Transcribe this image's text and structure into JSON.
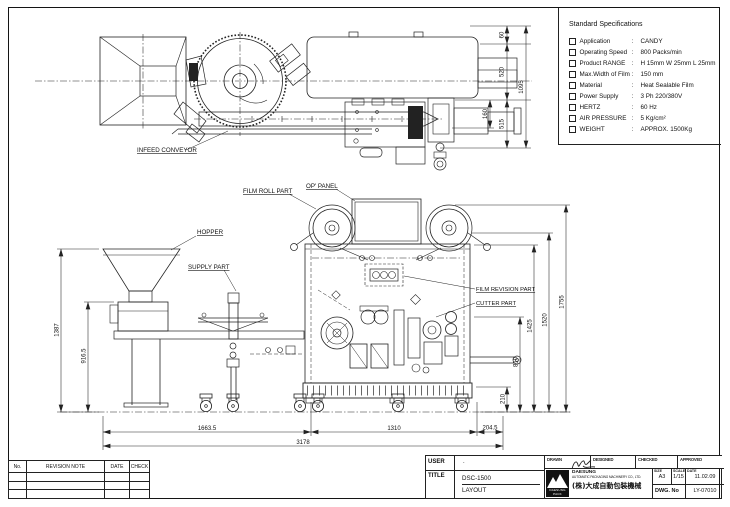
{
  "sheet": {
    "bg": "#ffffff",
    "line_color": "#1f1f1f"
  },
  "spec_panel": {
    "title": "Standard Specifications",
    "sep": ":",
    "items": [
      {
        "label": "Application",
        "value": "CANDY"
      },
      {
        "label": "Operating Speed",
        "value": "800  Packs/min"
      },
      {
        "label": "Product RANGE",
        "value": "H 15mm  W 25mm  L 25mm"
      },
      {
        "label": "Max.Width of Film",
        "value": "150 mm"
      },
      {
        "label": "Material",
        "value": "Heat Sealable Film"
      },
      {
        "label": "Power Supply",
        "value": "3 Ph 220/380V"
      },
      {
        "label": "HERTZ",
        "value": "60 Hz"
      },
      {
        "label": "AIR PRESSURE",
        "value": "5 Kg/cm²"
      },
      {
        "label": "WEIGHT",
        "value": "APPROX. 1500Kg"
      }
    ]
  },
  "part_labels": {
    "infeed_conveyor": "INFEED CONVEYOR",
    "film_roll_part": "FILM ROLL PART",
    "op_panel": "OP' PANEL",
    "hopper": "HOPPER",
    "supply_part": "SUPPLY PART",
    "film_revision_part": "FILM REVISION PART",
    "cutter_part": "CUTTER PART"
  },
  "dims": {
    "top": {
      "d60": "60",
      "d520": "520",
      "d515": "515",
      "d1095": "1095",
      "d160": "160"
    },
    "front_right": {
      "d1755": "1755",
      "d1520": "1520",
      "d1425": "1425",
      "d810": "810",
      "d210": "210"
    },
    "front_left": {
      "d1387": "1387",
      "d916": "916.5"
    },
    "bottom": {
      "d1663": "1663.5",
      "d1310": "1310",
      "d204": "204.5",
      "d3178": "3178"
    }
  },
  "revision_table": {
    "headers": [
      "No.",
      "REVISION NOTE",
      "DATE",
      "CHECK"
    ]
  },
  "title_block": {
    "user_label": "USER",
    "user_value": ".",
    "title_label": "TITLE",
    "drawing_title": "DSC-1500",
    "drawing_subtitle": "LAYOUT",
    "sign_columns": [
      "DRAWN",
      "DESIGNED",
      "CHECKED",
      "APPROVED"
    ],
    "logo_caption": "DAESUNG PACK",
    "company_name": "DAESUNG",
    "company_full": "AUTOMATIC PACKAGING MACHINERY CO., LTD.",
    "company_cjk": "(株)大成自動包裝機械",
    "size_label": "SIZE",
    "size_value": "A3",
    "scale_label": "SCALE",
    "scale_value": "1/15",
    "date_label": "DATE",
    "date_value": "11.02.09",
    "dwg_label": "DWG. No",
    "dwg_value": "LY-07010"
  }
}
